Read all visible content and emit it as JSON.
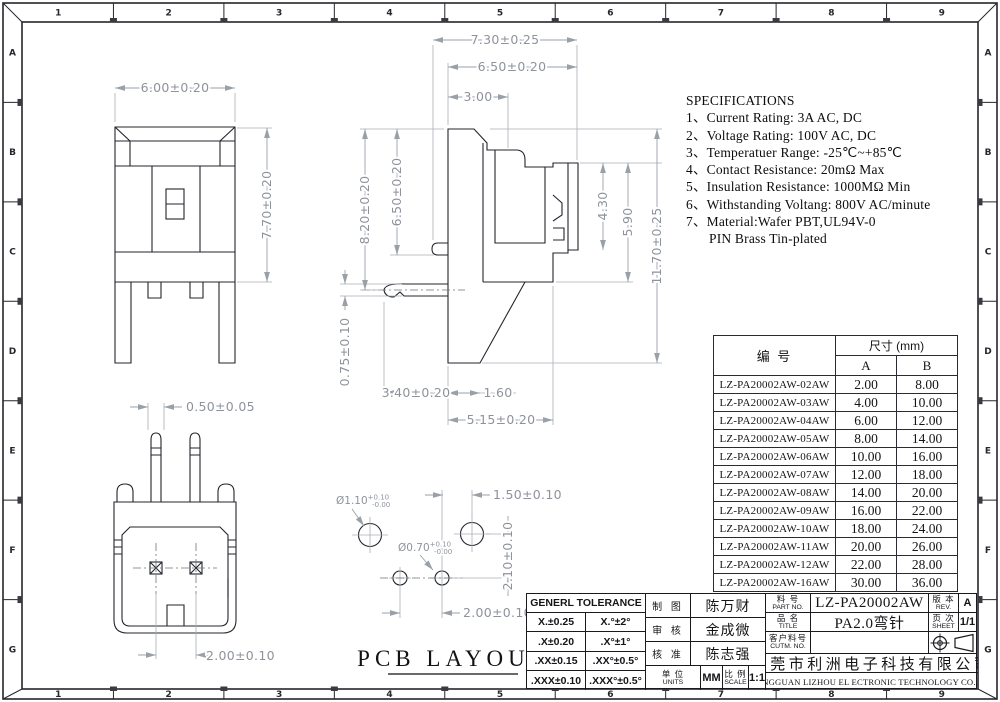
{
  "grid": {
    "columns": [
      "1",
      "2",
      "3",
      "4",
      "5",
      "6",
      "7",
      "8",
      "9"
    ],
    "rows": [
      "A",
      "B",
      "C",
      "D",
      "E",
      "F",
      "G"
    ]
  },
  "specifications": {
    "title": "SPECIFICATIONS",
    "items": [
      "1、Current Rating: 3A AC, DC",
      "2、Voltage Rating: 100V AC, DC",
      "3、Temperatuer Range: -25℃~+85℃",
      "4、Contact Resistance: 20mΩ Max",
      "5、Insulation Resistance: 1000MΩ Min",
      "6、Withstanding Voltang: 800V AC/minute",
      "7、Material:Wafer PBT,UL94V-0"
    ],
    "continuation": "PIN Brass Tin-plated"
  },
  "dimensions": {
    "front_width": "6.00±0.20",
    "front_height": "7.70±0.20",
    "side_width_total": "7.30±0.25",
    "side_width_housing": "6.50±0.20",
    "side_width_step": "3.00",
    "side_height_pin": "8.20±0.20",
    "side_height_boss": "6.50±0.20",
    "side_height_plate": "4.30",
    "side_height_shroud": "5.90",
    "side_height_total": "11.70±0.25",
    "pin_thickness": "0.75±0.10",
    "pin_length": "3.40±0.20",
    "base_foot": "1.60",
    "base_width": "5.15±0.20",
    "tail_width": "0.50±0.05",
    "tail_pitch": "2.00±0.10",
    "pcb_offset_x": "1.50±0.10",
    "pcb_offset_y": "2.10±0.10",
    "pcb_pitch": "2.00±0.10",
    "hole_large": {
      "dia": "Ø1.10",
      "tol_plus": "+0.10",
      "tol_minus": "-0.00"
    },
    "hole_small": {
      "dia": "Ø0.70",
      "tol_plus": "+0.10",
      "tol_minus": "-0.00"
    }
  },
  "pcb_layout_label": "PCB LAYOUT",
  "parts_table": {
    "col_part": "编 号",
    "col_size": "尺寸 (mm)",
    "col_a": "A",
    "col_b": "B",
    "rows": [
      {
        "part": "LZ-PA20002AW-02AW",
        "a": "2.00",
        "b": "8.00"
      },
      {
        "part": "LZ-PA20002AW-03AW",
        "a": "4.00",
        "b": "10.00"
      },
      {
        "part": "LZ-PA20002AW-04AW",
        "a": "6.00",
        "b": "12.00"
      },
      {
        "part": "LZ-PA20002AW-05AW",
        "a": "8.00",
        "b": "14.00"
      },
      {
        "part": "LZ-PA20002AW-06AW",
        "a": "10.00",
        "b": "16.00"
      },
      {
        "part": "LZ-PA20002AW-07AW",
        "a": "12.00",
        "b": "18.00"
      },
      {
        "part": "LZ-PA20002AW-08AW",
        "a": "14.00",
        "b": "20.00"
      },
      {
        "part": "LZ-PA20002AW-09AW",
        "a": "16.00",
        "b": "22.00"
      },
      {
        "part": "LZ-PA20002AW-10AW",
        "a": "18.00",
        "b": "24.00"
      },
      {
        "part": "LZ-PA20002AW-11AW",
        "a": "20.00",
        "b": "26.00"
      },
      {
        "part": "LZ-PA20002AW-12AW",
        "a": "22.00",
        "b": "28.00"
      },
      {
        "part": "LZ-PA20002AW-16AW",
        "a": "30.00",
        "b": "36.00"
      }
    ]
  },
  "title_block": {
    "tolerance": {
      "title": "GENERL TOLERANCE",
      "rows": [
        [
          "X.±0.25",
          "X.°±2°"
        ],
        [
          ".X±0.20",
          ".X°±1°"
        ],
        [
          ".XX±0.15",
          ".XX°±0.5°"
        ],
        [
          ".XXX±0.10",
          ".XXX°±0.5°"
        ]
      ]
    },
    "approvals": [
      {
        "role": "制 图",
        "name": "陈万财"
      },
      {
        "role": "审 核",
        "name": "金成微"
      },
      {
        "role": "核 准",
        "name": "陈志强"
      }
    ],
    "units": {
      "label_cn": "单 位",
      "label_en": "UNITS",
      "value": "MM"
    },
    "scale": {
      "label_cn": "比 例",
      "label_en": "SCALE",
      "value": "1:1"
    },
    "part_no": {
      "label_cn": "料 号",
      "label_en": "PART NO.",
      "value": "LZ-PA20002AW"
    },
    "rev": {
      "label_cn": "版 本",
      "label_en": "REV.",
      "value": "A"
    },
    "product": {
      "label_cn": "品 名",
      "label_en": "TITLE",
      "value": "PA2.0弯针"
    },
    "sheet": {
      "label_cn": "页 次",
      "label_en": "SHEET",
      "value": "1/1"
    },
    "customer": {
      "label_cn": "客户料号",
      "label_en": "CUTM. NO.",
      "value": ""
    },
    "company_cn": "东莞市利洲电子科技有限公司",
    "company_en": "DONGGUAN LIZHOU EL ECTRONIC TECHNOLOGY CO.,LTD"
  }
}
